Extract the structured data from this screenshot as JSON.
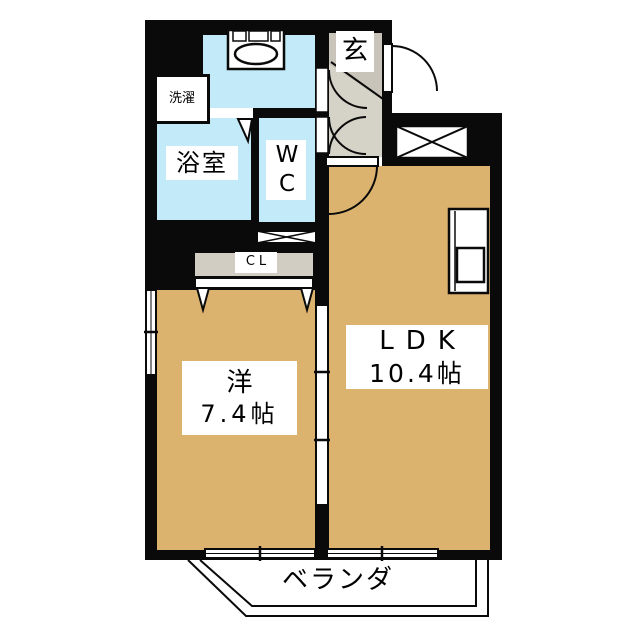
{
  "plan": {
    "title": "apartment-floor-plan",
    "rooms": {
      "entrance": {
        "label": "玄"
      },
      "laundry": {
        "label": "洗濯"
      },
      "bathroom": {
        "label": "浴室"
      },
      "toilet": {
        "label": "WC"
      },
      "closet": {
        "label": "CL"
      },
      "western_room": {
        "label": "洋",
        "size": "7.4帖"
      },
      "ldk": {
        "label": "LDK",
        "size": "10.4帖"
      },
      "veranda": {
        "label": "ベランダ"
      }
    },
    "colors": {
      "wall": "#0a0a0a",
      "wet_room": "#c2eaf8",
      "flooring": "#dcb26f",
      "entrance_floor": "#c8c4ba",
      "hall_floor": "#d5d2c8",
      "closet_floor": "#d1cdc3",
      "background": "#ffffff"
    }
  }
}
